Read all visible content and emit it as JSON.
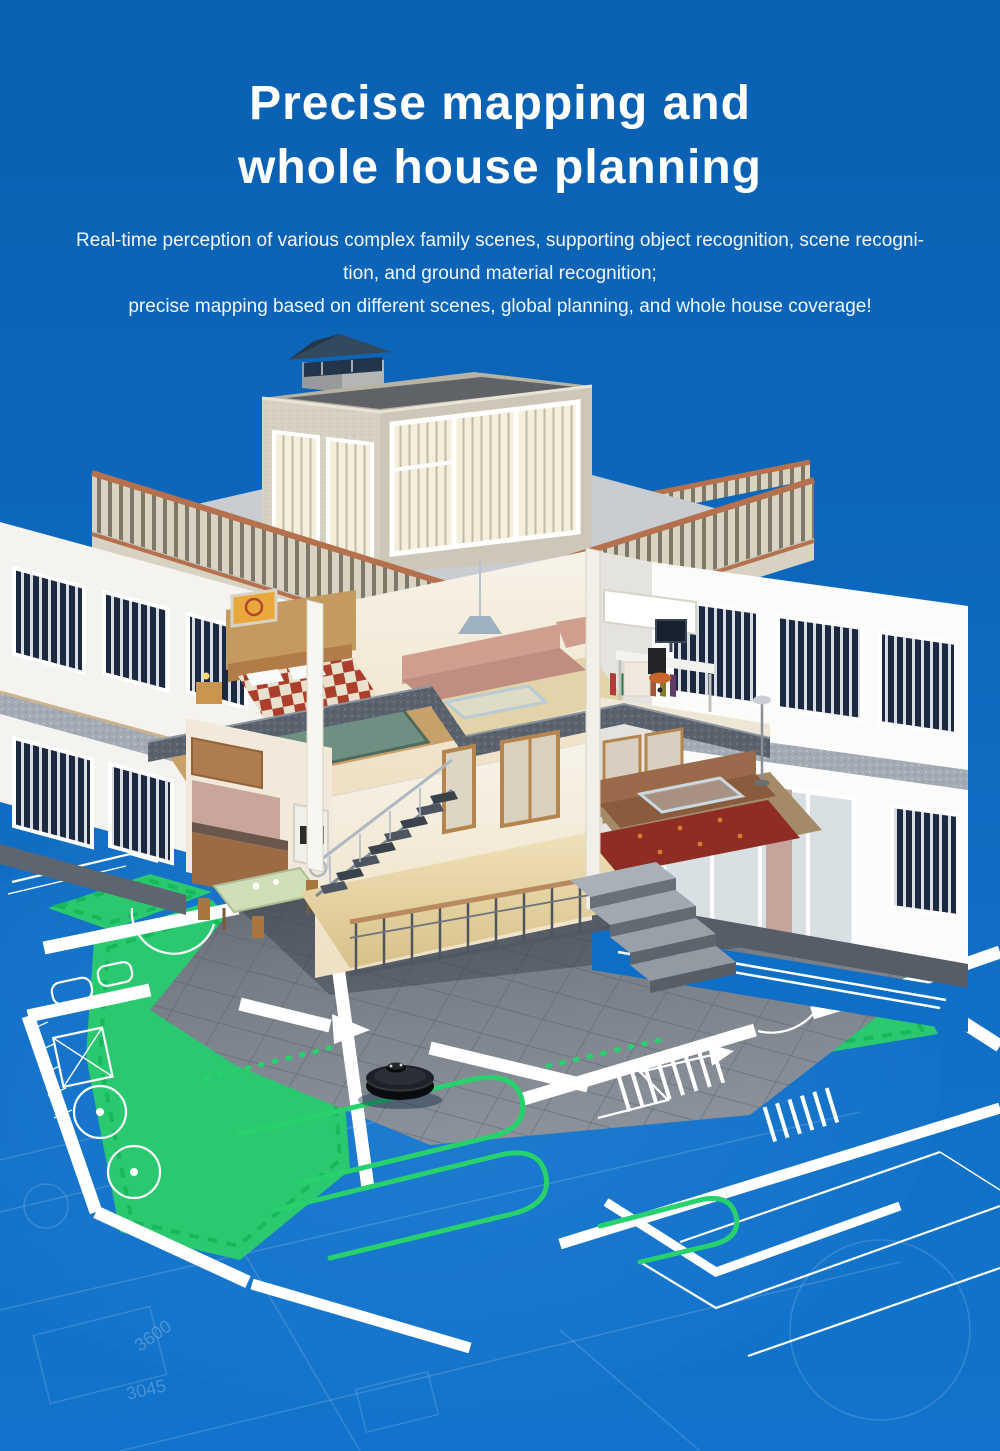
{
  "header": {
    "title_line1": "Precise mapping and",
    "title_line2": "whole house planning",
    "body_line1": "Real-time perception of various complex family scenes, supporting object recognition, scene recogni-",
    "body_line2": "tion, and ground material recognition;",
    "body_line3": "precise mapping based on different scenes, global planning, and whole house coverage!"
  },
  "scene": {
    "alt": "3D cutaway two-story house standing on a blue blueprint floor plan; a black robot vacuum follows green cleaning paths over green cleaned zones",
    "dimension_labels": [
      "3045",
      "3600"
    ],
    "colors": {
      "background_blue": "#0c66ba",
      "blueprint_line": "#ffffff",
      "clean_zone_green": "#2bc96f",
      "clean_path_green": "#27d16c",
      "terracotta_rail": "#b5714e",
      "stucco_beige": "#d3cec0",
      "slab_gray": "#59616d",
      "patio_stone": "#7b828b",
      "robot_black": "#141519"
    }
  }
}
